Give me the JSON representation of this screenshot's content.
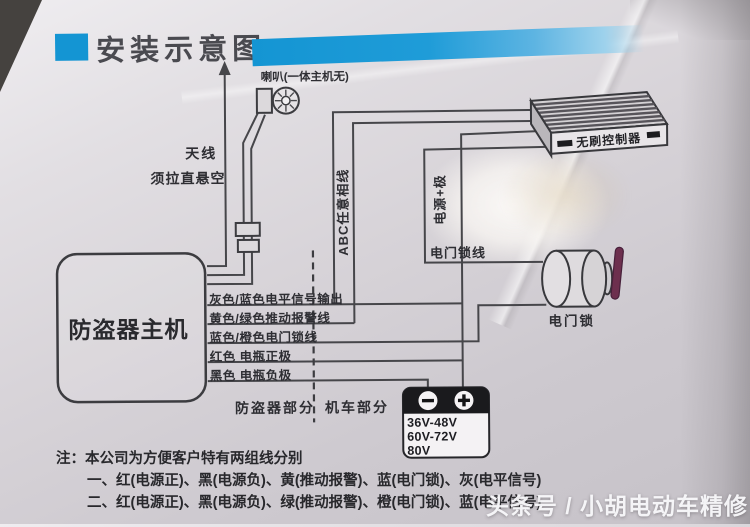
{
  "title": "安装示意图",
  "diagram": {
    "horn_label": "喇叭(一体主机无)",
    "antenna_line1": "天线",
    "antenna_line2": "须拉直悬空",
    "abc_phase_label": "ABC任意相线",
    "power_positive_label": "电源+极",
    "controller_label": "无刷控制器",
    "ignition_wire_label": "电门锁线",
    "ignition_lock_label": "电门锁",
    "main_unit_label": "防盗器主机",
    "wires": [
      "灰色/蓝色电平信号输出",
      "黄色/绿色推动报警线",
      "蓝色/橙色电门锁线",
      "红色 电瓶正极",
      "黑色 电瓶负极"
    ],
    "section_left_label": "防盗器部分",
    "section_right_label": "机车部分",
    "battery": {
      "minus": "−",
      "plus": "+",
      "voltages": [
        "36V-48V",
        "60V-72V",
        "80V"
      ]
    }
  },
  "notes": {
    "header": "注：本公司为方便客户特有两组线分别",
    "item1": "一、红(电源正)、黑(电源负)、黄(推动报警)、蓝(电门锁)、灰(电平信号)",
    "item2": "二、红(电源正)、黑(电源负)、绿(推动报警)、橙(电门锁)、蓝(电平信号)"
  },
  "watermark": "头条号 / 小胡电动车精修",
  "colors": {
    "accent_blue": "#1495d3",
    "wire_gray": "#46464a",
    "key_red": "#6d2f4e",
    "paper": "#d8d5d8"
  }
}
